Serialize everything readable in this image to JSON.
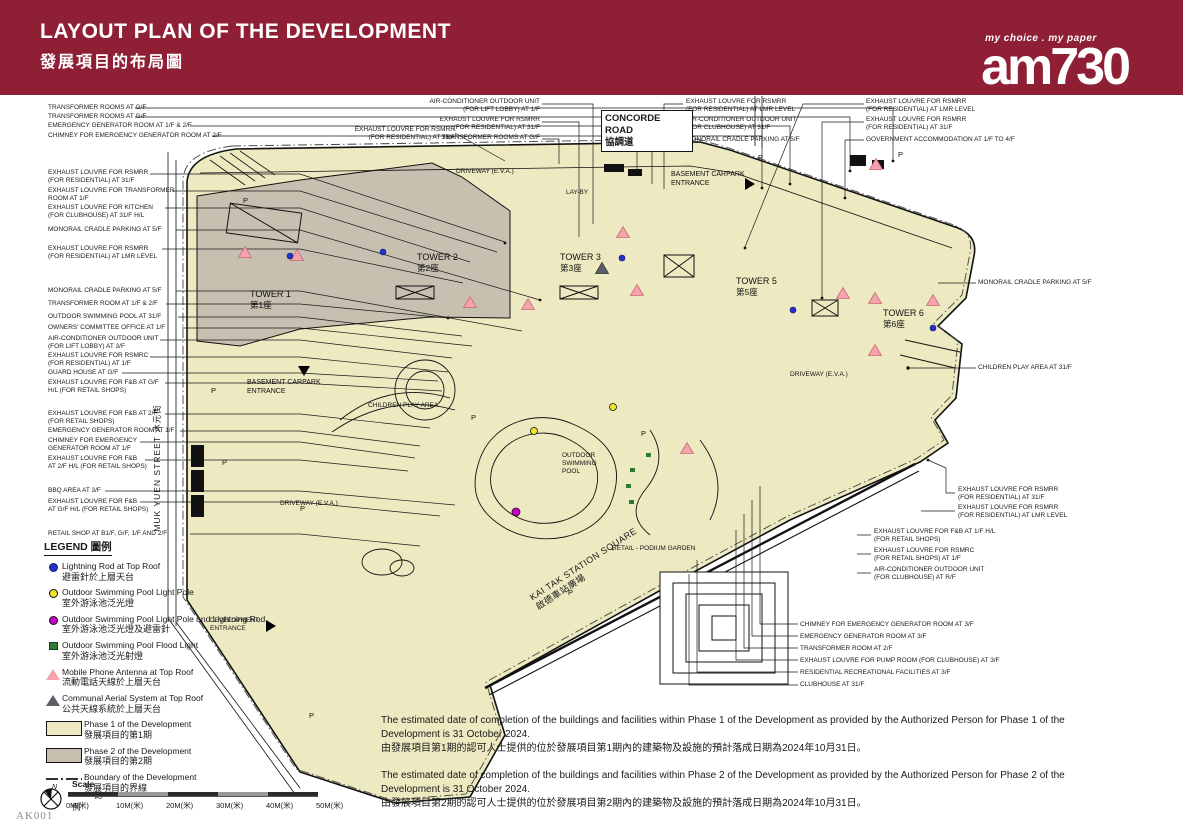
{
  "header": {
    "title_en": "LAYOUT PLAN OF THE DEVELOPMENT",
    "title_zh": "發展項目的布局圖",
    "brand": "am730",
    "brand_tagline": "my choice . my paper"
  },
  "doc_code": "AK001",
  "roads": {
    "concorde_en": "CONCORDE ROAD",
    "concorde_zh": "協調道",
    "muk_yuen": "MUK YUEN STREET 沐元街",
    "kai_tak_en": "KAI TAK STATION SQUARE",
    "kai_tak_zh": "啟德車站廣場"
  },
  "towers": [
    {
      "en": "TOWER 1",
      "zh": "第1座"
    },
    {
      "en": "TOWER 2",
      "zh": "第2座"
    },
    {
      "en": "TOWER 3",
      "zh": "第3座"
    },
    {
      "en": "TOWER 5",
      "zh": "第5座"
    },
    {
      "en": "TOWER 6",
      "zh": "第6座"
    }
  ],
  "areas": {
    "driveway": "DRIVEWAY (E.V.A.)",
    "layby": "LAY-BY",
    "basement_carpark": "BASEMENT CARPARK\nENTRANCE",
    "children_play": "CHILDREN PLAY AREA",
    "outdoor_pool": "OUTDOOR\nSWIMMING\nPOOL",
    "retail_podium": "RETAIL - PODIUM GARDEN",
    "development_entrance": "DEVELOPMENT\nENTRANCE",
    "parking": "P"
  },
  "callouts": {
    "left": [
      "TRANSFORMER ROOMS AT G/F",
      "TRANSFORMER ROOMS AT G/F",
      "EMERGENCY GENERATOR ROOM AT 1/F & 2/F",
      "CHIMNEY FOR EMERGENCY GENERATOR ROOM AT 2/F",
      "EXHAUST LOUVRE FOR RSMRR\n(FOR RESIDENTIAL) AT 31/F",
      "EXHAUST LOUVRE FOR TRANSFORMER\nROOM AT 1/F",
      "EXHAUST LOUVRE FOR KITCHEN\n(FOR CLUBHOUSE) AT 31/F H/L",
      "MONORAIL CRADLE PARKING AT 5/F",
      "EXHAUST LOUVRE FOR RSMRR\n(FOR RESIDENTIAL) AT LMR LEVEL",
      "MONORAIL CRADLE PARKING AT 5/F",
      "TRANSFORMER ROOM AT 1/F & 2/F",
      "OUTDOOR SWIMMING POOL AT 31/F",
      "OWNERS' COMMITTEE OFFICE AT 1/F",
      "AIR-CONDITIONER OUTDOOR UNIT\n(FOR LIFT LOBBY) AT 3/F",
      "EXHAUST LOUVRE FOR RSMRC\n(FOR RESIDENTIAL) AT 1/F",
      "GUARD HOUSE AT G/F",
      "EXHAUST LOUVRE FOR F&B AT G/F\nH/L (FOR RETAIL SHOPS)",
      "EXHAUST LOUVRE FOR F&B AT 2/F\n(FOR RETAIL SHOPS)",
      "EMERGENCY GENERATOR ROOM AT 1/F",
      "CHIMNEY FOR EMERGENCY\nGENERATOR ROOM AT 1/F",
      "EXHAUST LOUVRE FOR F&B\nAT 2/F H/L (FOR RETAIL SHOPS)",
      "BBQ AREA AT 3/F",
      "EXHAUST LOUVRE FOR F&B\nAT G/F H/L (FOR RETAIL SHOPS)",
      "RETAIL SHOP AT B1/F, G/F, 1/F AND 2/F"
    ],
    "top": [
      "AIR-CONDITIONER OUTDOOR UNIT\n(FOR LIFT LOBBY) AT 1/F",
      "EXHAUST LOUVRE FOR RSMRR\n(FOR RESIDENTIAL) AT 31/F",
      "TRANSFORMER ROOMS AT G/F",
      "EXHAUST LOUVRE FOR RSMRR\n(FOR RESIDENTIAL) AT 31/F"
    ],
    "top_mid": [
      "EXHAUST LOUVRE FOR RSMRR\n(FOR RESIDENTIAL) AT LMR LEVEL",
      "AIR-CONDITIONER OUTDOOR UNIT\n(FOR CLUBHOUSE) AT 31/F",
      "MONORAIL CRADLE PARKING AT 5/F"
    ],
    "top_right": [
      "EXHAUST LOUVRE FOR RSMRR\n(FOR RESIDENTIAL) AT LMR LEVEL",
      "EXHAUST LOUVRE FOR RSMRR\n(FOR RESIDENTIAL) AT 31/F",
      "GOVERNMENT ACCOMMODATION AT 1/F TO 4/F"
    ],
    "right": [
      "MONORAIL CRADLE PARKING AT 5/F",
      "CHILDREN PLAY AREA AT 31/F",
      "EXHAUST LOUVRE FOR RSMRR\n(FOR RESIDENTIAL) AT 31/F",
      "EXHAUST LOUVRE FOR RSMRR\n(FOR RESIDENTIAL) AT LMR LEVEL",
      "EXHAUST LOUVRE FOR F&B AT 1/F H/L\n(FOR RETAIL SHOPS)",
      "EXHAUST LOUVRE FOR RSMRC\n(FOR RETAIL SHOPS) AT 1/F",
      "AIR-CONDITIONER OUTDOOR UNIT\n(FOR CLUBHOUSE) AT R/F"
    ],
    "bottom_right": [
      "CHIMNEY FOR EMERGENCY GENERATOR ROOM AT 3/F",
      "EMERGENCY GENERATOR ROOM AT 3/F",
      "TRANSFORMER ROOM AT 2/F",
      "EXHAUST LOUVRE FOR PUMP ROOM (FOR CLUBHOUSE) AT 3/F",
      "RESIDENTIAL RECREATIONAL FACILITIES AT 3/F",
      "CLUBHOUSE AT 31/F"
    ]
  },
  "legend": {
    "title": "LEGEND 圖例",
    "items": [
      {
        "en": "Lightning Rod at Top Roof",
        "zh": "避雷針於上層天台"
      },
      {
        "en": "Outdoor Swimming Pool Light Pole",
        "zh": "室外游泳池泛光燈"
      },
      {
        "en": "Outdoor Swimming Pool Light Pole and Lightning Rod",
        "zh": "室外游泳池泛光燈及避雷針"
      },
      {
        "en": "Outdoor Swimming Pool Flood Light",
        "zh": "室外游泳池泛光射燈"
      },
      {
        "en": "Mobile Phone Antenna at Top Roof",
        "zh": "流動電話天線於上層天台"
      },
      {
        "en": "Communal Aerial System at Top Roof",
        "zh": "公共天線系統於上層天台"
      },
      {
        "en": "Phase 1 of the Development",
        "zh": "發展項目的第1期"
      },
      {
        "en": "Phase 2 of the Development",
        "zh": "發展項目的第2期"
      },
      {
        "en": "Boundary of the Development",
        "zh": "發展項目的界線"
      }
    ]
  },
  "scalebar": {
    "north": "N",
    "label_en": "Scale",
    "label_zh": "比例",
    "ticks": [
      "0M(米)",
      "10M(米)",
      "20M(米)",
      "30M(米)",
      "40M(米)",
      "50M(米)"
    ]
  },
  "notes": [
    {
      "en": "The estimated date of completion of the buildings and facilities within Phase 1 of the Development as provided by the Authorized Person for Phase 1 of the Development is 31 October 2024.",
      "zh": "由發展項目第1期的認可人士提供的位於發展項目第1期內的建築物及設施的預計落成日期為2024年10月31日。"
    },
    {
      "en": "The estimated date of completion of the buildings and facilities within Phase 2 of the Development as provided by the Authorized Person for Phase 2 of the Development is 31 October 2024.",
      "zh": "由發展項目第2期的認可人士提供的位於發展項目第2期內的建築物及設施的預計落成日期為2024年10月31日。"
    }
  ],
  "colors": {
    "header_bg": "#8E1F35",
    "phase1_fill": "#EDE9C1",
    "phase2_fill": "#C7C0B1",
    "antenna_pink": "#F4A3AE",
    "aerial_gray": "#5B6068",
    "lightning_blue": "#2430C8",
    "pool_light_yellow": "#F2E32B",
    "pool_light_magenta": "#CC00CC",
    "flood_light_green": "#2F7A33"
  }
}
